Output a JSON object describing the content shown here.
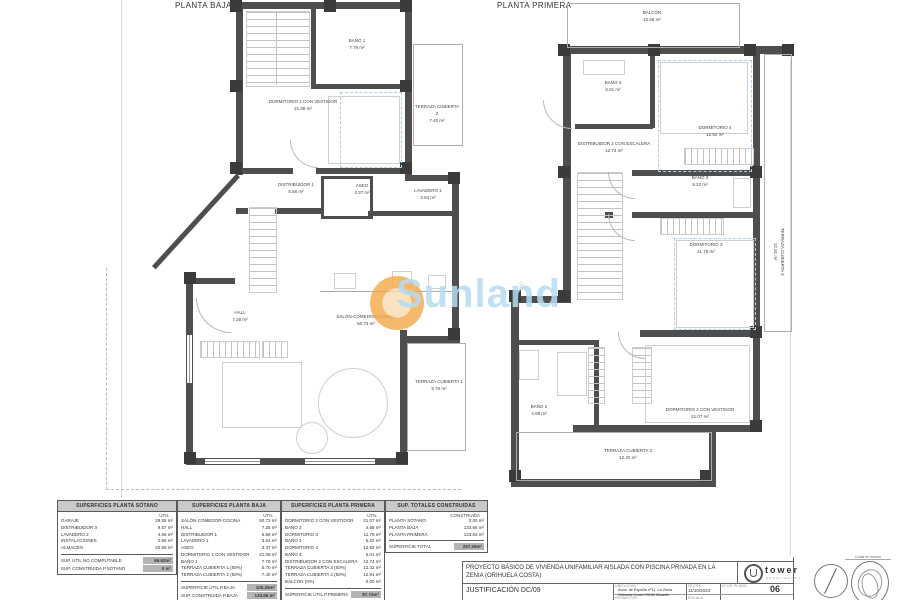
{
  "plans": {
    "baja": {
      "title": "PLANTA BAJA",
      "rooms": [
        {
          "name": "BAÑO 1",
          "area": "7.79 m²"
        },
        {
          "name": "DORMITORIO 1 CON VESTIDOR",
          "area": "21.08 m²"
        },
        {
          "name": "TERRAZA CUBIERTA 2",
          "area": "7.40 m²"
        },
        {
          "name": "DISTRIBUIDOR 1",
          "area": "5.58 m²"
        },
        {
          "name": "ASEO",
          "area": "3.37 m²"
        },
        {
          "name": "LAVADERO 1",
          "area": "3.54 m²"
        },
        {
          "name": "HALL",
          "area": "7.26 m²"
        },
        {
          "name": "SALÓN-COMEDOR-COCINA",
          "area": "50.73 m²"
        },
        {
          "name": "TERRAZA CUBIERTA 1",
          "area": "5.70 m²"
        }
      ]
    },
    "primera": {
      "title": "PLANTA PRIMERA",
      "rooms": [
        {
          "name": "BALCÓN",
          "area": "10.66 m²"
        },
        {
          "name": "BAÑO 4",
          "area": "6.01 m²"
        },
        {
          "name": "DORMITORIO 4",
          "area": "12.82 m²"
        },
        {
          "name": "DISTRIBUIDOR 2 CON ESCALERA",
          "area": "12.74 m²"
        },
        {
          "name": "BAÑO 3",
          "area": "5.22 m²"
        },
        {
          "name": "DORMITORIO 3",
          "area": "11.78 m²"
        },
        {
          "name": "TERRAZA CUBIERTA 4",
          "area": "12.91 m²"
        },
        {
          "name": "BAÑO 2",
          "area": "4.68 m²"
        },
        {
          "name": "DORMITORIO 2 CON VESTIDOR",
          "area": "21.07 m²"
        },
        {
          "name": "TERRAZA CUBIERTA 3",
          "area": "12.32 m²"
        }
      ]
    }
  },
  "watermark": {
    "text": "Sunland",
    "reg": "®",
    "text_color": "#b7dbf0",
    "sun_color": "#f2a847"
  },
  "tables": [
    {
      "title": "SUPERFICIES PLANTA SÓTANO",
      "col_header": "ÚTIL",
      "rows": [
        {
          "label": "GARAJE",
          "value": "29.55 m²"
        },
        {
          "label": "DISTRIBUIDOR 3",
          "value": "9.57 m²"
        },
        {
          "label": "LAVADERO 2",
          "value": "4.66 m²"
        },
        {
          "label": "INSTALACIONES",
          "value": "2.65 m²"
        },
        {
          "label": "ALMACÉN",
          "value": "20.59 m²"
        }
      ],
      "totals": [
        {
          "label": "SUP. ÚTIL NO COMPUTABLE",
          "value": "66.92m²"
        },
        {
          "label": "SUP. CONSTRUIDA P.SÓTANO",
          "value": "0 m²"
        }
      ]
    },
    {
      "title": "SUPERFICIES PLANTA BAJA",
      "col_header": "ÚTIL",
      "rows": [
        {
          "label": "SALÓN-COMEDOR-COCINA",
          "value": "50.73 m²"
        },
        {
          "label": "HALL",
          "value": "7.26 m²"
        },
        {
          "label": "DISTRIBUIDOR 1",
          "value": "5.58 m²"
        },
        {
          "label": "LAVADERO 1",
          "value": "3.54 m²"
        },
        {
          "label": "ASEO",
          "value": "3.37 m²"
        },
        {
          "label": "DORMITORIO 1 CON VESTIDOR",
          "value": "21.08 m²"
        },
        {
          "label": "BAÑO 1",
          "value": "7.79 m²"
        },
        {
          "label": "TERRAZA CUBIERTA 1 (50%)",
          "value": "5.70 m²"
        },
        {
          "label": "TERRAZA CUBIERTA 2 (50%)",
          "value": "7.40 m²"
        }
      ],
      "totals": [
        {
          "label": "SUPERFICIE ÚTIL P.BAJA",
          "value": "105.29m²"
        },
        {
          "label": "SUP. CONSTRUIDA P.BAJA",
          "value": "133.66 m²"
        }
      ]
    },
    {
      "title": "SUPERFICIES PLANTA PRIMERA",
      "col_header": "ÚTIL",
      "rows": [
        {
          "label": "DORMITORIO 2 CON VESTIDOR",
          "value": "21.07 m²"
        },
        {
          "label": "BAÑO 2",
          "value": "4.68 m²"
        },
        {
          "label": "DORMITORIO 3",
          "value": "11.78 m²"
        },
        {
          "label": "BAÑO 3",
          "value": "5.22 m²"
        },
        {
          "label": "DORMITORIO 4",
          "value": "12.82 m²"
        },
        {
          "label": "BAÑO 4",
          "value": "6.01 m²"
        },
        {
          "label": "DISTRIBUIDOR 2 CON ESCALERA",
          "value": "12.74 m²"
        },
        {
          "label": "TERRAZA CUBIERTA 3 (50%)",
          "value": "12.32 m²"
        },
        {
          "label": "TERRAZA CUBIERTA 4 (50%)",
          "value": "12.91 m²"
        },
        {
          "label": "BALCÓN (0%)",
          "value": "0.00 m²"
        }
      ],
      "totals": [
        {
          "label": "SUPERFICIE ÚTIL P.PRIMERA",
          "value": "87.74m²"
        },
        {
          "label": "SUP. CONSTRUIDA P.PRIMERA",
          "value": "123.63 m²"
        }
      ]
    },
    {
      "title": "SUP. TOTALES CONSTRUIDAS",
      "col_header": "CONSTRUIDA",
      "rows": [
        {
          "label": "PLANTA SÓTANO",
          "value": "0.00 m²"
        },
        {
          "label": "PLANTA BAJA",
          "value": "133.66 m²"
        },
        {
          "label": "PLANTA PRIMERA",
          "value": "123.63 m²"
        }
      ],
      "totals": [
        {
          "label": "SUPERFICIE TOTAL",
          "value": "257.29m²"
        }
      ]
    }
  ],
  "titleblock": {
    "project_title": "PROYECTO BÁSICO DE VIVIENDA UNIFAMILIAR AISLADA CON PISCINA PRIVADA EN LA ZENIA (ORIHUELA COSTA)",
    "drawing_title": "JUSTIFICACIÓN DC/09",
    "logo_name": "tower",
    "logo_sub": "ARQUITECTOS",
    "ubicacion_label": "UBICACIÓN",
    "ubicacion_line1": "Avda. de España nº11, La Zenia",
    "ubicacion_line2": "Orihuela Costa 03189 Alicante",
    "fecha_label": "FECHA",
    "fecha_value": "11/10/2023",
    "plano_label": "Nº DE PLANO",
    "plano_value": "06",
    "promotor_label": "PROMOTOR",
    "escala_label": "ESCALA",
    "cotas_note": "Cotas en metros"
  }
}
